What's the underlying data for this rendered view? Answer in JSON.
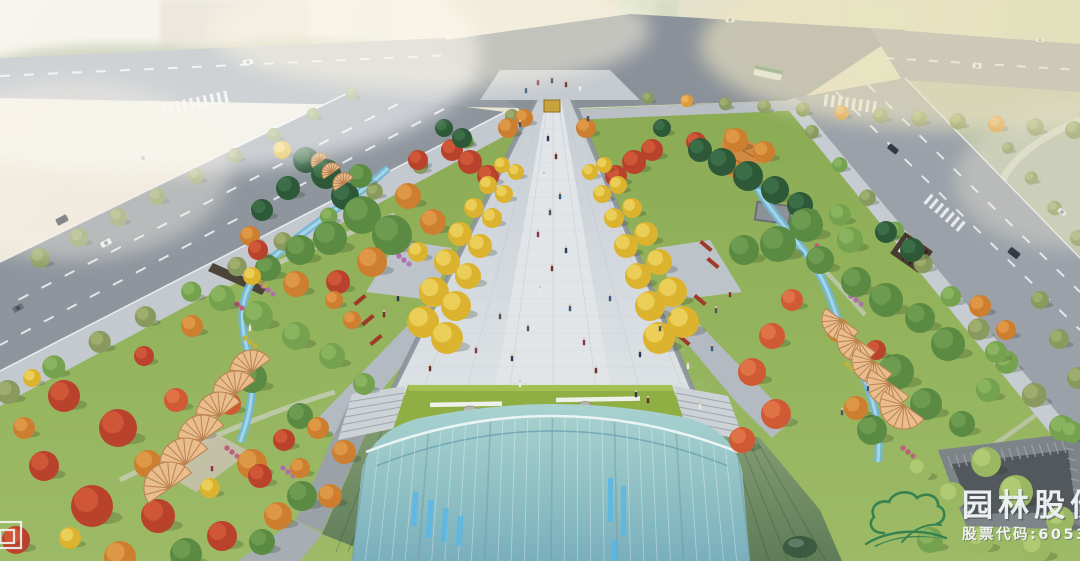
{
  "scene": {
    "type": "aerial architectural rendering",
    "subject": "urban park plaza with central tree-lined pedestrian axis, sunken building with arched glass roof, perimeter roads and autumn planting"
  },
  "watermark": {
    "company_name": "园林股份",
    "stock_label": "股票代码:605303",
    "logo": "cloud-leaf-logo",
    "logo_color": "#2f7d4e",
    "text_color": "#eceff1"
  },
  "palette": {
    "asphalt": "#8e959d",
    "asphalt_light": "#9aa1a9",
    "sidewalk": "#c3c9cf",
    "plaza": "#d3d8dc",
    "plaza_center": "#e1e5e8",
    "plaza_side": "#b6bdc4",
    "lawn": "#93b25c",
    "lawn_dark": "#7da24c",
    "glass_roof_1": "#a9d2d0",
    "glass_roof_2": "#7fb3c2",
    "metal_roof_1": "#86a075",
    "metal_roof_2": "#64815c",
    "stream": "#74b7d4",
    "stream_light": "#a8d8ea",
    "fan_canopy": "#e9bd8e",
    "fan_rib": "#b9824f",
    "conifer": "#2d5939",
    "tree_green": "#5b8a43",
    "tree_green_lt": "#74a24e",
    "tree_lime": "#9ab862",
    "tree_olive": "#8a9a5e",
    "tree_orange": "#cd7f2f",
    "tree_orange_lt": "#de9a3c",
    "tree_red": "#b8422b",
    "tree_red_lt": "#cf5a33",
    "ginkgo": "#d8a42a",
    "ginkgo_lt": "#ecc84d",
    "seat_wall_red": "#9e3a28",
    "courtyard_floor": "#53585c",
    "courtyard_wall": "#7e8589",
    "haze": "#f4efe2",
    "field": "#b7bfa8"
  }
}
